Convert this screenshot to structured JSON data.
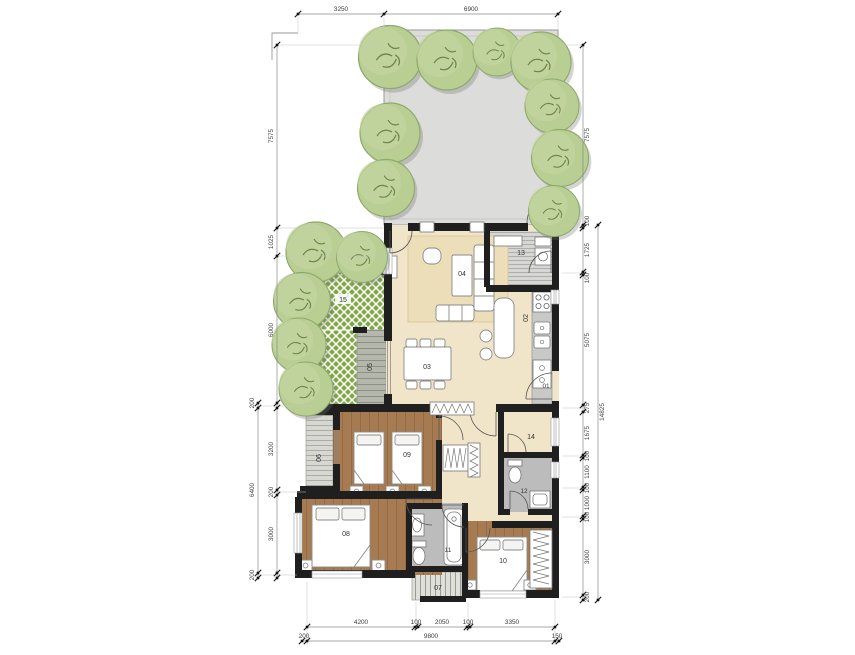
{
  "colors": {
    "wall": "#1f1f1f",
    "floor_cream": "#f1e5c9",
    "floor_wood": "#a67b51",
    "floor_bath": "#bcbcbc",
    "patio_gray": "#dcdcda",
    "deck_gray": "#b4b8ac",
    "tree_green": "#b9ce93",
    "lattice_green": "#7ea844",
    "rug_beige": "#ecdeb9",
    "dim_text": "#3a3a3a"
  },
  "room_labels": {
    "r01": "01",
    "r02": "02",
    "r03": "03",
    "r04": "04",
    "r05": "05",
    "r06": "06",
    "r07": "07",
    "r08": "08",
    "r09": "09",
    "r10": "10",
    "r11": "11",
    "r12": "12",
    "r13": "13",
    "r14": "14",
    "r15": "15"
  },
  "dimensions": {
    "top": [
      "3250",
      "6900"
    ],
    "left_chain": [
      "7575",
      "1025",
      "6000",
      "3200",
      "200",
      "3000"
    ],
    "left_outer": [
      "200",
      "6400",
      "200"
    ],
    "right_chain": [
      "7575",
      "100",
      "1725",
      "100",
      "5075",
      "275",
      "1675",
      "100",
      "1100",
      "100",
      "1000",
      "100",
      "3000",
      "200"
    ],
    "right_outer": [
      "14825"
    ],
    "bottom_chain": [
      "4200",
      "100",
      "2050",
      "100",
      "3350"
    ],
    "bottom_outer": [
      "200",
      "9800",
      "150"
    ]
  }
}
